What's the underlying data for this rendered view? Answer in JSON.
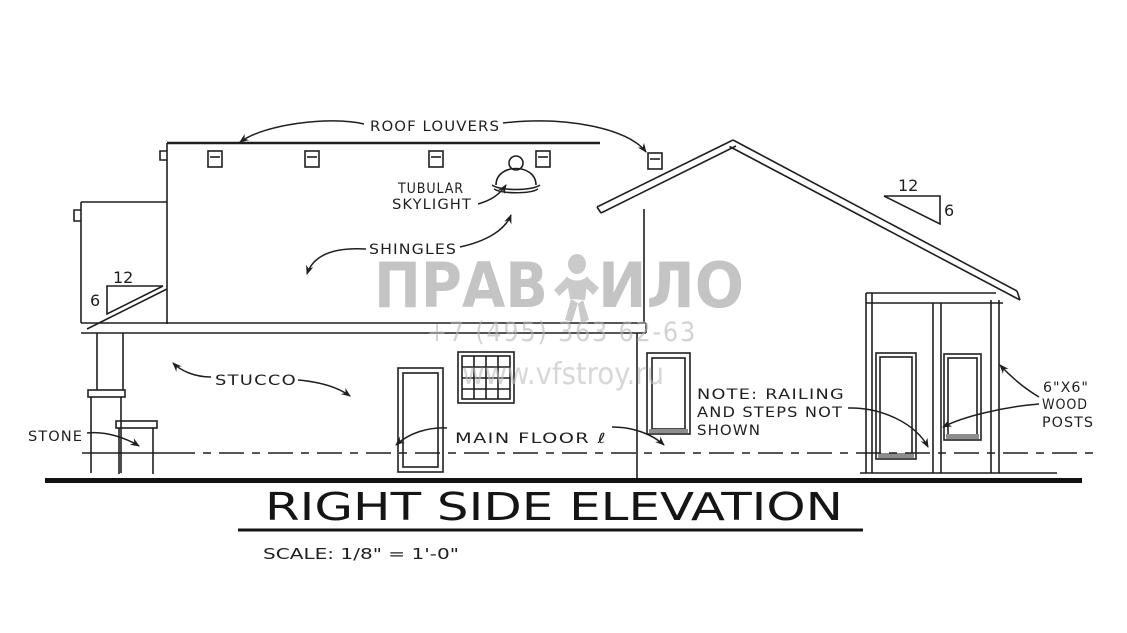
{
  "drawing": {
    "kind": "architectural side elevation blueprint",
    "ink_color": "#1f1f1f",
    "background": "#ffffff"
  },
  "title_block": {
    "title": "RIGHT SIDE ELEVATION",
    "scale_label": "SCALE: 1/8\" = 1'-0\""
  },
  "annotations": {
    "roof_louvers": "ROOF LOUVERS",
    "tubular_skylight_line1": "TUBULAR",
    "tubular_skylight_line2": "SKYLIGHT",
    "shingles": "SHINGLES",
    "stucco": "STUCCO",
    "stone": "STONE",
    "main_floor": "MAIN FLOOR ℓ",
    "note_line1": "NOTE:  RAILING",
    "note_line2": "AND STEPS NOT",
    "note_line3": "SHOWN",
    "wood_posts_line1": "6\"X6\"",
    "wood_posts_line2": "WOOD",
    "wood_posts_line3": "POSTS"
  },
  "slope_indicators": {
    "left_run": "12",
    "left_rise": "6",
    "right_run": "12",
    "right_rise": "6"
  },
  "watermark": {
    "brand_left": "ПРАВ",
    "brand_right": "ИЛО",
    "phone": "+7 (495) 363 62-63",
    "website": "www.vfstroy.ru",
    "color": "#b0b0b0"
  }
}
